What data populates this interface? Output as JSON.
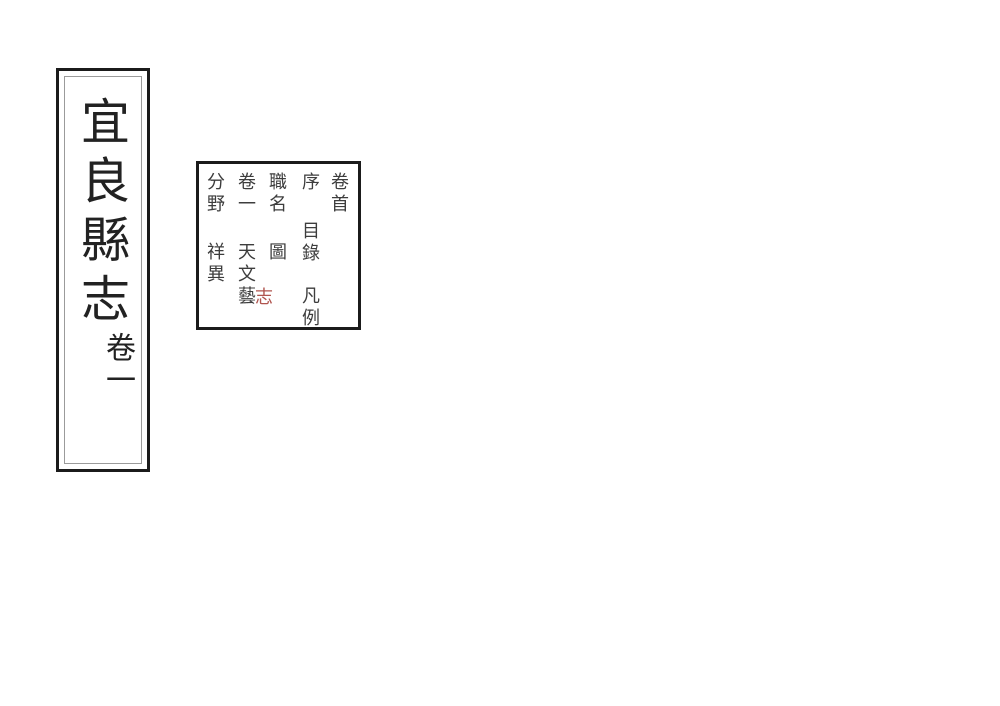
{
  "title_panel": {
    "book_title": "宜良縣志",
    "volume_label": "卷一"
  },
  "contents_panel": {
    "columns": [
      {
        "id": "col-1",
        "entries": [
          "卷首"
        ]
      },
      {
        "id": "col-2",
        "entries": [
          "序",
          "目錄",
          "凡例"
        ]
      },
      {
        "id": "col-3",
        "entries": [
          "職名",
          "圖"
        ]
      },
      {
        "id": "col-4",
        "entries": [
          "卷一",
          "天文",
          "藝"
        ]
      },
      {
        "id": "col-5",
        "entries": [
          "分野",
          "祥異"
        ]
      }
    ],
    "annotation": {
      "text": "志",
      "color": "#b0544e"
    }
  },
  "colors": {
    "background": "#ffffff",
    "frame_border": "#1b1b1b",
    "inner_frame_border": "#9b9b9b",
    "title_text": "#222222",
    "toc_text": "#3d3d3d",
    "annotation_red": "#b0544e"
  }
}
